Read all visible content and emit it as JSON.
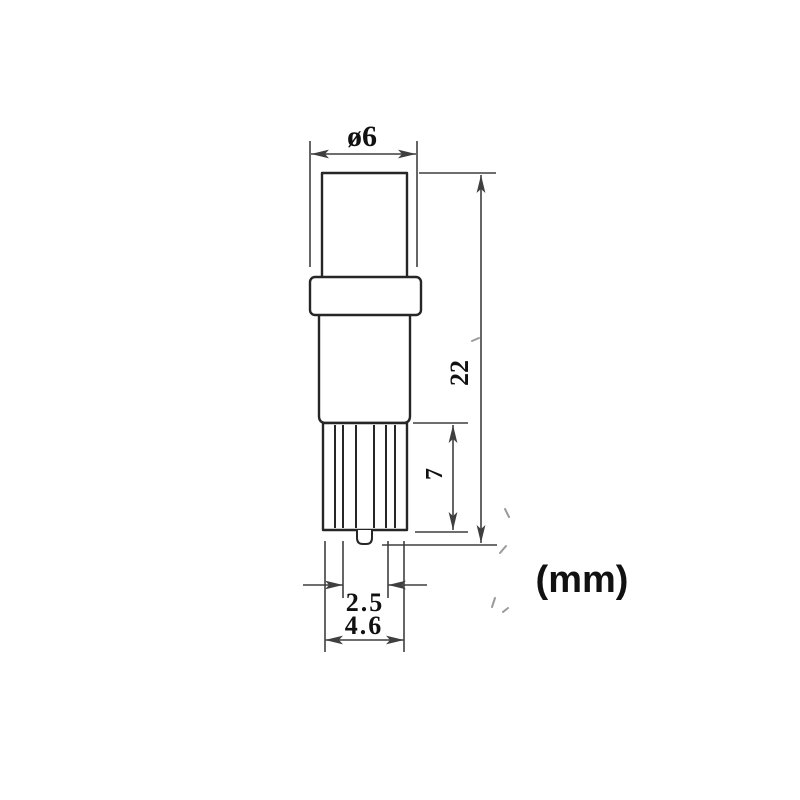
{
  "theme": {
    "bg": "#ffffff",
    "outline": "#262626",
    "dim": "#3f3f3f",
    "text": "#111111",
    "art": "#9a9a9a"
  },
  "diagram": {
    "type": "technical-dimension-drawing",
    "subject": "wedge-base bulb side elevation",
    "units_label": "(mm)",
    "labels": {
      "top_diameter": "ø6",
      "overall_height": "22",
      "base_section_height": "7",
      "contact_thickness": "2.5",
      "base_width": "4.6"
    },
    "dimensions_mm": {
      "top_diameter": 6,
      "overall_height": 22,
      "base_section_height": 7,
      "contact_thickness": 2.5,
      "base_width": 4.6
    }
  }
}
